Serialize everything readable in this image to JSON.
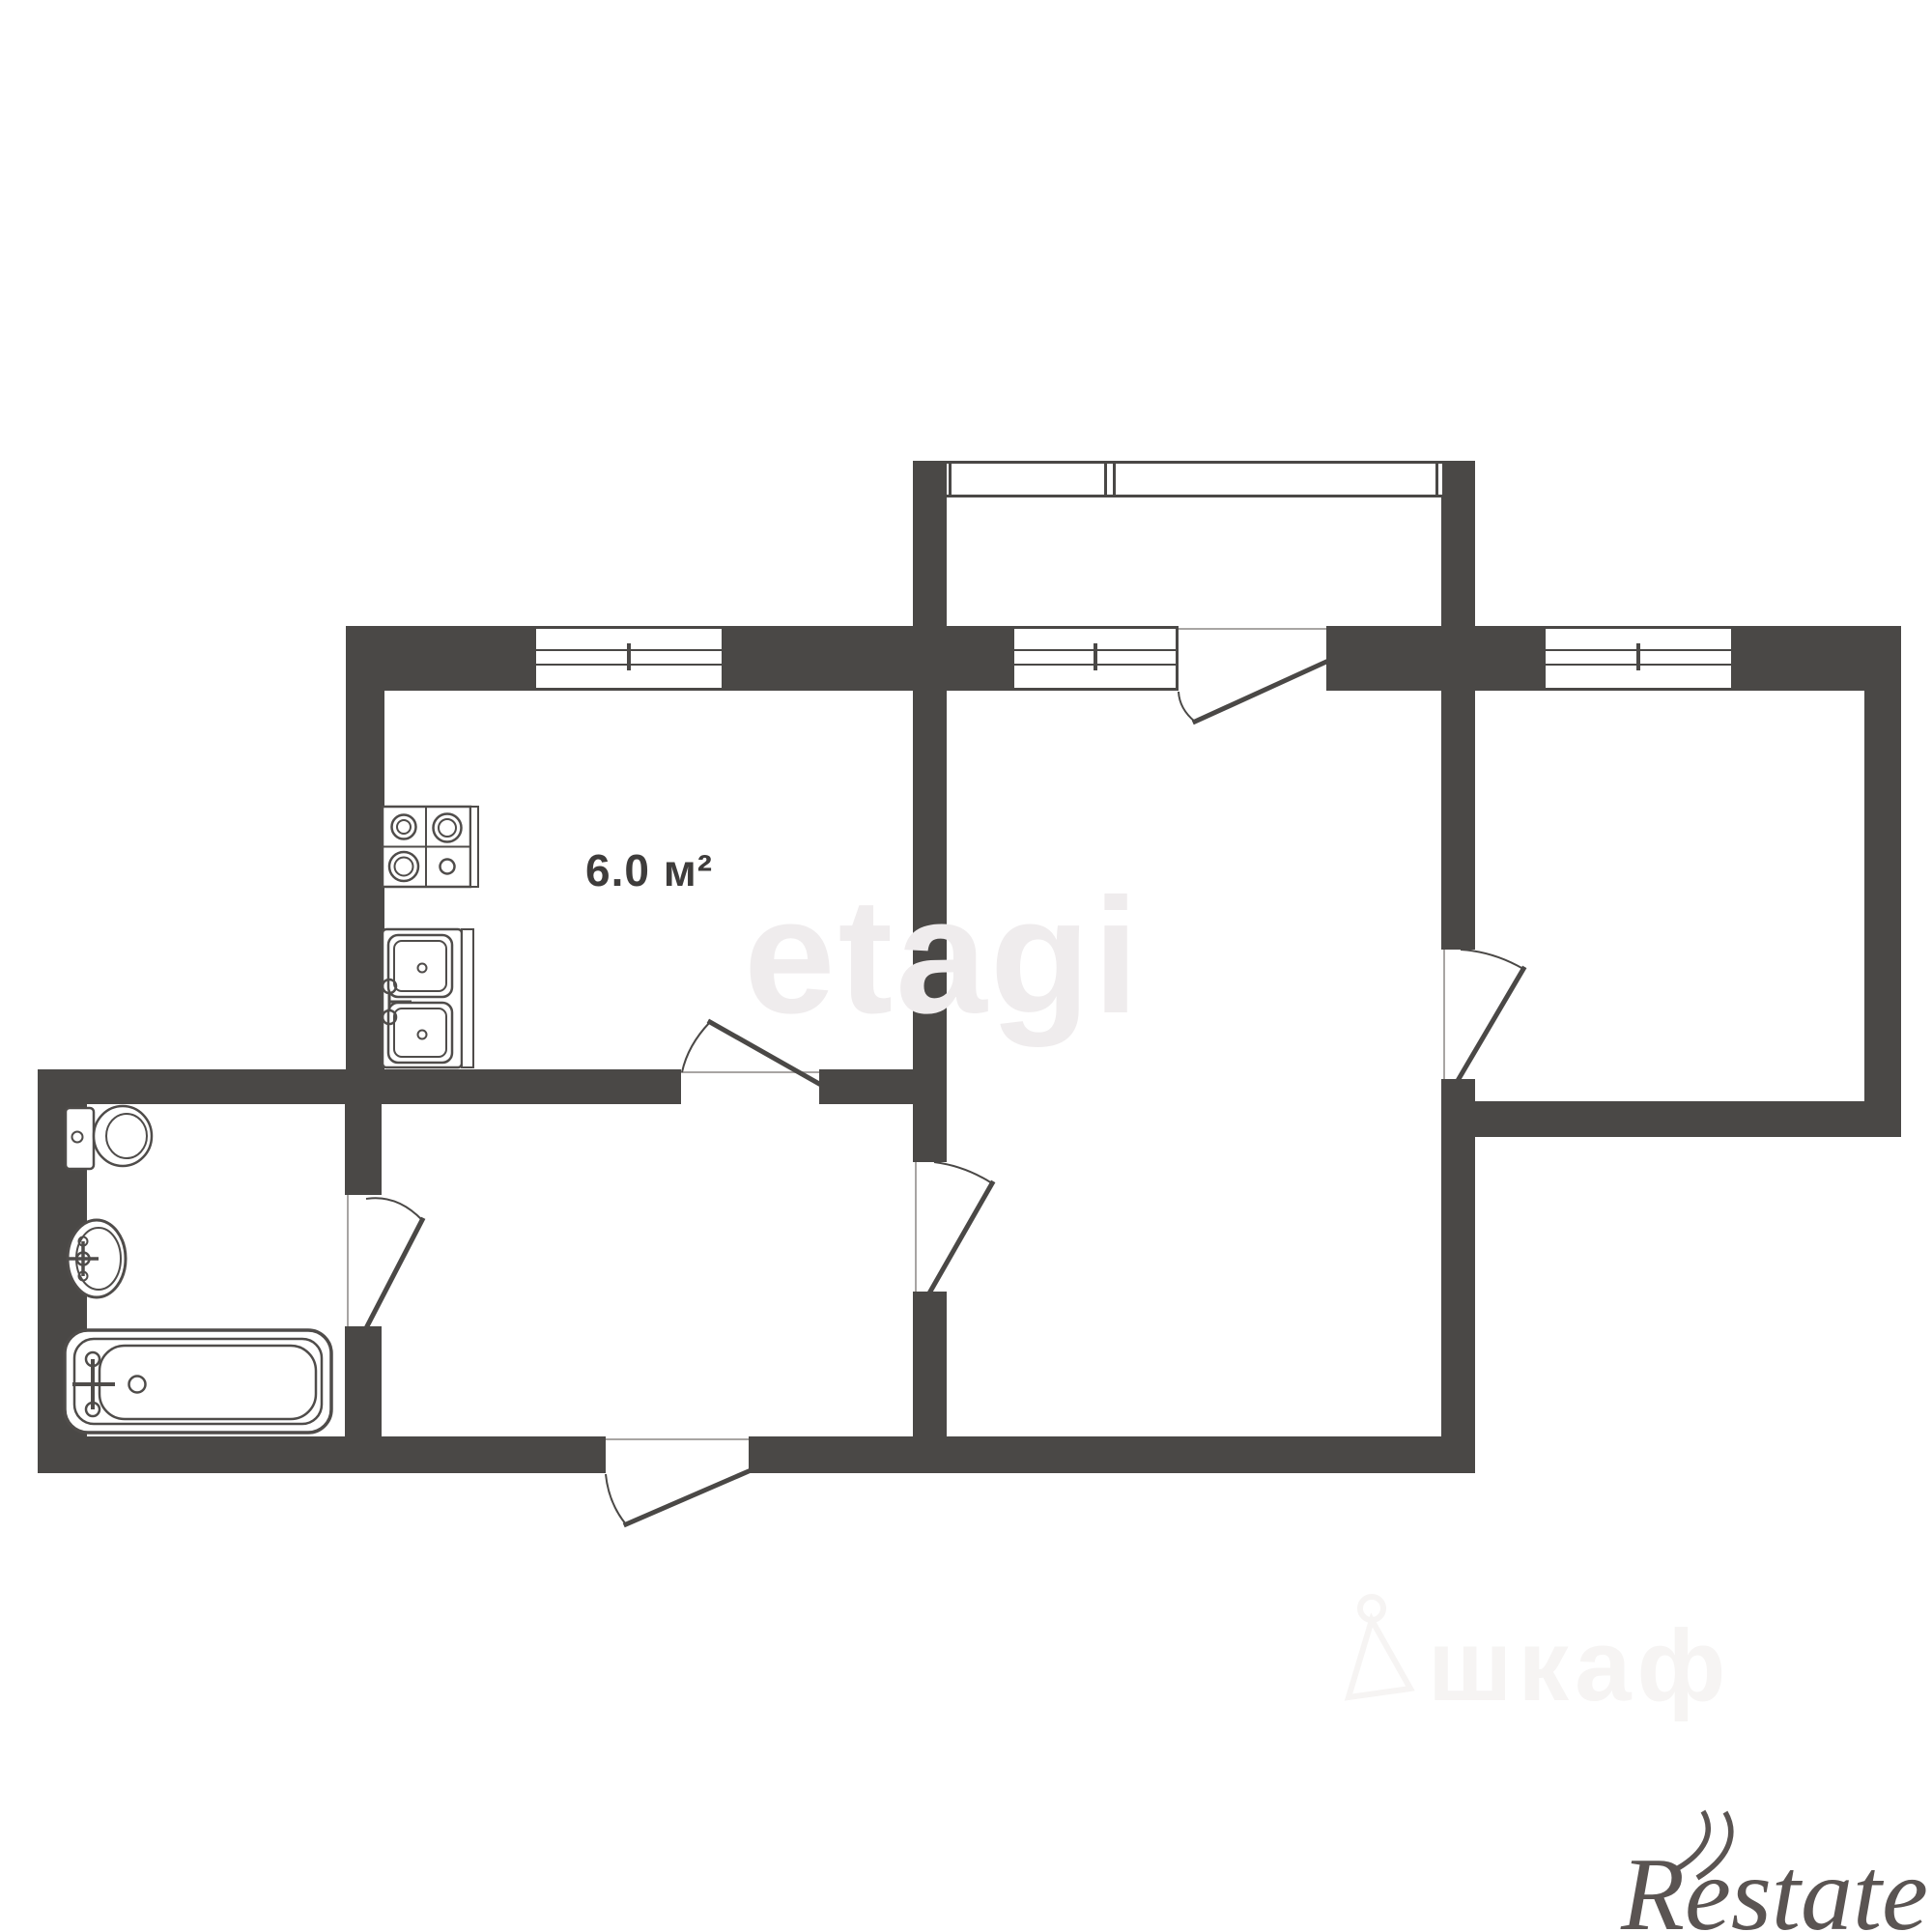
{
  "plan": {
    "area_label": "6.0 м²"
  },
  "watermarks": {
    "brand_center": "etagi",
    "closet_label": "шкаф",
    "agency_logo": "Restate"
  },
  "colors": {
    "background": "#ffffff",
    "wall": "#4a4846",
    "fixture_stroke": "#4f4c4a",
    "frame_line": "#a8a5a3",
    "area_label_text": "#3e3c3b",
    "watermark_center": "#efeced",
    "watermark_closet": "#f6f4f3",
    "agency_text": "#5a5452"
  },
  "icons": {
    "closet_hanger": "hanger-icon"
  }
}
